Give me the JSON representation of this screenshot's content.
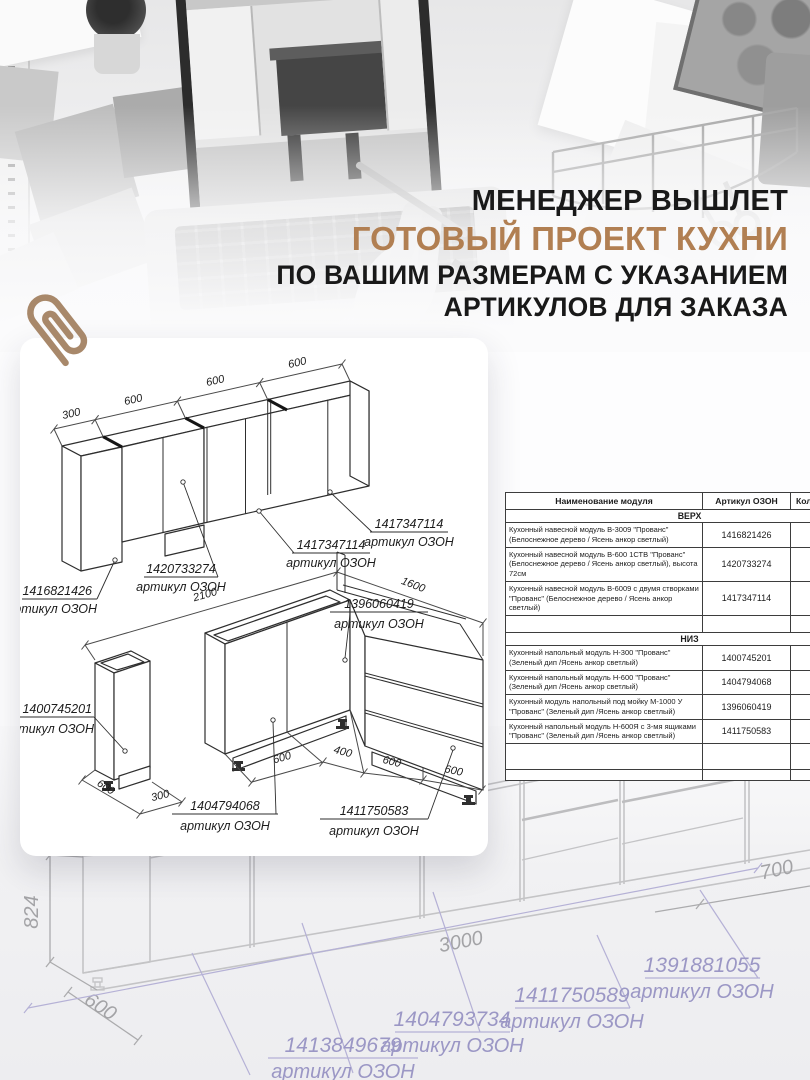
{
  "headline": {
    "line1": "МЕНЕДЖЕР ВЫШЛЕТ",
    "line2": "ГОТОВЫЙ ПРОЕКТ КУХНИ",
    "line3": "ПО ВАШИМ РАЗМЕРАМ С УКАЗАНИЕМ",
    "line4": "АРТИКУЛОВ ДЛЯ ЗАКАЗА",
    "accent_color": "#b17f52"
  },
  "plan": {
    "upper": {
      "dims": [
        "300",
        "600",
        "600",
        "600"
      ],
      "labels": [
        {
          "article": "1416821426",
          "caption": "артикул ОЗОН"
        },
        {
          "article": "1420733274",
          "caption": "артикул ОЗОН"
        },
        {
          "article": "1417347114",
          "caption": "артикул ОЗОН"
        },
        {
          "article": "1417347114",
          "caption": "артикул ОЗОН"
        }
      ]
    },
    "lower": {
      "dim_run_left": "2100",
      "dim_run_right": "1600",
      "cab300_dims": [
        "600",
        "300"
      ],
      "bottom_dims": [
        "600",
        "400",
        "600",
        "600"
      ],
      "labels": [
        {
          "article": "1400745201",
          "caption": "артикул ОЗОН"
        },
        {
          "article": "1396060419",
          "caption": "артикул ОЗОН"
        },
        {
          "article": "1404794068",
          "caption": "артикул ОЗОН"
        },
        {
          "article": "1411750583",
          "caption": "артикул ОЗОН"
        }
      ]
    }
  },
  "table": {
    "col_module": "Наименование модуля",
    "col_article": "Артикул ОЗОН",
    "col_qty": "Кол-во",
    "section_top": "ВЕРХ",
    "section_bottom": "НИЗ",
    "rows_top": [
      {
        "name": "Кухонный навесной модуль В-3009 \"Прованс\" (Белоснежное дерево / Ясень анкор светлый)",
        "article": "1416821426"
      },
      {
        "name": "Кухонный навесной модуль В-600 1СТВ \"Прованс\" (Белоснежное дерево / Ясень анкор светлый), высота 72см",
        "article": "1420733274"
      },
      {
        "name": "Кухонный навесной модуль В-6009 с двумя створками \"Прованс\" (Белоснежное дерево / Ясень анкор светлый)",
        "article": "1417347114"
      }
    ],
    "rows_bottom": [
      {
        "name": "Кухонный напольный модуль Н-300 \"Прованс\" (Зеленый дип /Ясень анкор светлый)",
        "article": "1400745201"
      },
      {
        "name": "Кухонный напольный модуль Н-600 \"Прованс\" (Зеленый дип /Ясень анкор светлый)",
        "article": "1404794068"
      },
      {
        "name": "Кухонный модуль напольный под мойку М-1000 У \"Прованс\" (Зеленый дип /Ясень анкор светлый)",
        "article": "1396060419"
      },
      {
        "name": "Кухонный напольный модуль Н-600Я с 3-мя ящиками \"Прованс\" (Зеленый дип /Ясень анкор светлый)",
        "article": "1411750583"
      }
    ]
  },
  "watermark": {
    "dim_height": "824",
    "dim_depth": "600",
    "dim_width": "3000",
    "dim_right": "700",
    "labels": [
      {
        "article": "1413849679",
        "caption": "артикул ОЗОН"
      },
      {
        "article": "1404793734",
        "caption": "артикул ОЗОН"
      },
      {
        "article": "1411750589",
        "caption": "артикул ОЗОН"
      },
      {
        "article": "1391881055",
        "caption": "артикул ОЗОН"
      }
    ]
  }
}
